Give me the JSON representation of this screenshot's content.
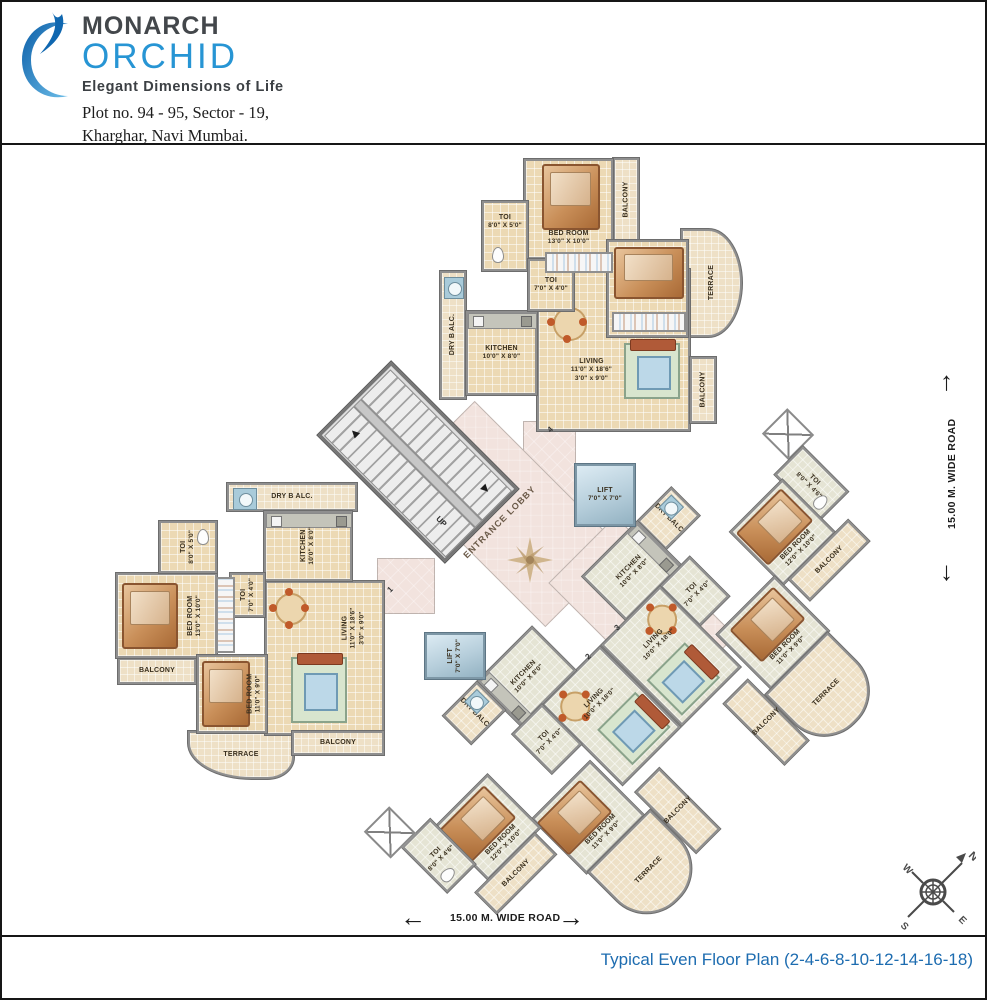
{
  "header": {
    "brand_top": "MONARCH",
    "brand_main": "ORCHID",
    "tagline": "Elegant Dimensions of Life",
    "address_line1": "Plot no. 94 - 95, Sector - 19,",
    "address_line2": "Kharghar, Navi Mumbai."
  },
  "footer": {
    "caption": "Typical Even Floor Plan (2-4-6-8-10-12-14-16-18)"
  },
  "plan": {
    "core": {
      "lobby": "ENTRANCE LOBBY",
      "up": "UP",
      "lift1": {
        "name": "LIFT",
        "dims": "7'0\" X 7'0\""
      },
      "lift2": {
        "name": "LIFT",
        "dims": "7'0\" X 7'0\""
      },
      "unit1": "1",
      "unit2": "2",
      "unit3": "3",
      "unit4": "4"
    },
    "roads": {
      "right": "15.00 M. WIDE ROAD",
      "bottom": "15.00 M. WIDE ROAD"
    },
    "compass": {
      "n": "N",
      "w": "W",
      "s": "S",
      "e": "E"
    },
    "rooms": {
      "t_bed13": {
        "name": "BED ROOM",
        "dims": "13'0\" X 10'0\""
      },
      "t_toi8": {
        "name": "TOI",
        "dims": "8'0\" X 5'0\""
      },
      "t_toi7": {
        "name": "TOI",
        "dims": "7'0\" X 4'0\""
      },
      "t_bed11": {
        "name": "BED ROOM",
        "dims": "11'0\" X 9'0\""
      },
      "t_kit": {
        "name": "KITCHEN",
        "dims": "10'0\" X 8'0\""
      },
      "t_liv": {
        "name": "LIVING",
        "dims": "11'0\" X 18'6\"",
        "dims2": "3'0\" x 9'0\""
      },
      "t_balc1": {
        "name": "BALCONY"
      },
      "t_balc2": {
        "name": "BALCONY"
      },
      "t_terr": {
        "name": "TERRACE"
      },
      "t_dry": {
        "name": "DRY B ALC."
      },
      "l_bed13": {
        "name": "BED ROOM",
        "dims": "13'0\" X 10'0\""
      },
      "l_toi8": {
        "name": "TOI",
        "dims": "8'0\" X 5'0\""
      },
      "l_toi7": {
        "name": "TOI",
        "dims": "7'0\" X 4'0\""
      },
      "l_bed11": {
        "name": "BED ROOM",
        "dims": "11'0\" X 9'0\""
      },
      "l_kit": {
        "name": "KITCHEN",
        "dims": "10'0\" X 8'0\""
      },
      "l_liv": {
        "name": "LIVING",
        "dims": "11'0\" X 18'6\"",
        "dims2": "3'0\" x 9'0\""
      },
      "l_balc1": {
        "name": "BALCONY"
      },
      "l_balc2": {
        "name": "BALCONY"
      },
      "l_terr": {
        "name": "TERRACE"
      },
      "l_dry": {
        "name": "DRY B ALC."
      },
      "d3_dry": {
        "name": "DRY BALC"
      },
      "d3_kit": {
        "name": "KITCHEN",
        "dims": "10'0\" X 8'0\""
      },
      "d3_toi7": {
        "name": "TOI",
        "dims": "7'0\" X 4'0\""
      },
      "d3_toi8": {
        "name": "TOI",
        "dims": "8'0\" X 4'6\""
      },
      "d3_bed12": {
        "name": "BED ROOM",
        "dims": "12'0\" X 10'0\""
      },
      "d3_bed11": {
        "name": "BED ROOM",
        "dims": "11'0\" X 9'0\""
      },
      "d3_liv": {
        "name": "LIVING",
        "dims": "10'0\" X 18'0\""
      },
      "d3_balc1": {
        "name": "BALCONY"
      },
      "d3_balc2": {
        "name": "BALCONY"
      },
      "d3_terr": {
        "name": "TERRACE"
      },
      "d2_dry": {
        "name": "DRY BALC"
      },
      "d2_kit": {
        "name": "KITCHEN",
        "dims": "10'0\" X 8'0\""
      },
      "d2_toi7": {
        "name": "TOI",
        "dims": "7'0\" X 4'0\""
      },
      "d2_toi8": {
        "name": "TOI",
        "dims": "8'0\" X 4'6\""
      },
      "d2_bed12": {
        "name": "BED ROOM",
        "dims": "12'0\" X 10'0\""
      },
      "d2_bed11": {
        "name": "BED ROOM",
        "dims": "11'0\" X 9'0\""
      },
      "d2_liv": {
        "name": "LIVING",
        "dims": "10'0\" X 18'0\""
      },
      "d2_balc1": {
        "name": "BALCONY"
      },
      "d2_balc2": {
        "name": "BALCONY"
      },
      "d2_terr": {
        "name": "TERRACE"
      }
    },
    "colors": {
      "tile": "#ecd9b4",
      "wing_tile": "#e5e4d4",
      "lobby": "#f2e3de",
      "lift": "#b6cedb",
      "wall": "#8f8f8f",
      "accent_blue": "#2795d4",
      "caption_blue": "#1d6cb0"
    }
  }
}
